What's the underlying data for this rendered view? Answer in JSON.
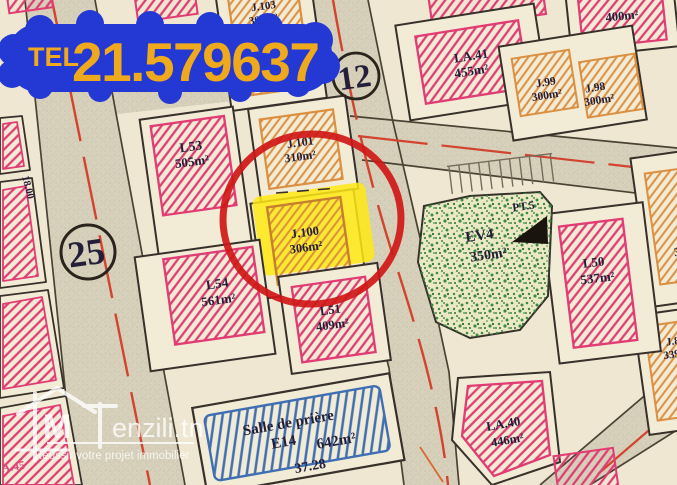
{
  "phone": {
    "label": "TEL",
    "number": "21.579637"
  },
  "markers": {
    "circle_top": "12",
    "circle_left": "25"
  },
  "measurements": {
    "left_road_width": "18.00",
    "salle_frontage": "37.28"
  },
  "plots": {
    "l53": {
      "name": "L53",
      "area": "505m²"
    },
    "j101": {
      "name": "J.101",
      "area": "310m²"
    },
    "j100": {
      "name": "J.100",
      "area": "306m²"
    },
    "l54": {
      "name": "L54",
      "area": "561m²"
    },
    "l51": {
      "name": "L51",
      "area": "409m²"
    },
    "l50": {
      "name": "L50",
      "area": "537m²"
    },
    "la41": {
      "name": "LA.41",
      "area": "455m²"
    },
    "j99": {
      "name": "J.99",
      "area": "300m²"
    },
    "j98": {
      "name": "J.98",
      "area": "300m²"
    },
    "j103": {
      "name": "J.103",
      "area": "300m²"
    },
    "p400": {
      "area": "400m²"
    },
    "la40": {
      "name": "LA.40",
      "area": "446m²"
    },
    "ev4": {
      "name": "EV4",
      "area": "350m²"
    },
    "pt5": {
      "name": "PT.5"
    },
    "salle": {
      "name": "Salle de prière",
      "code": "E14",
      "area": "642m²"
    },
    "right_mid_fragment": {
      "area": "34"
    },
    "right_low_fragment": {
      "name": "J.8",
      "area": "339"
    },
    "corner_fragment": {
      "name": "A.45"
    }
  },
  "watermark": {
    "logo": "M",
    "brand": "enzili.tn",
    "tagline": "Réussir votre projet immobilier"
  },
  "colors": {
    "phone_bubble": "#2438d4",
    "phone_text": "#efa91c",
    "highlight_circle": "#cf1717",
    "highlight_marker": "#ffe913",
    "hatch_pink": "#e03d74",
    "hatch_orange": "#db8f40",
    "hatch_blue": "#3f6fb2",
    "green_space": "#3d8a40",
    "road_centerline": "#d24330",
    "paper": "#f2ebd6"
  }
}
